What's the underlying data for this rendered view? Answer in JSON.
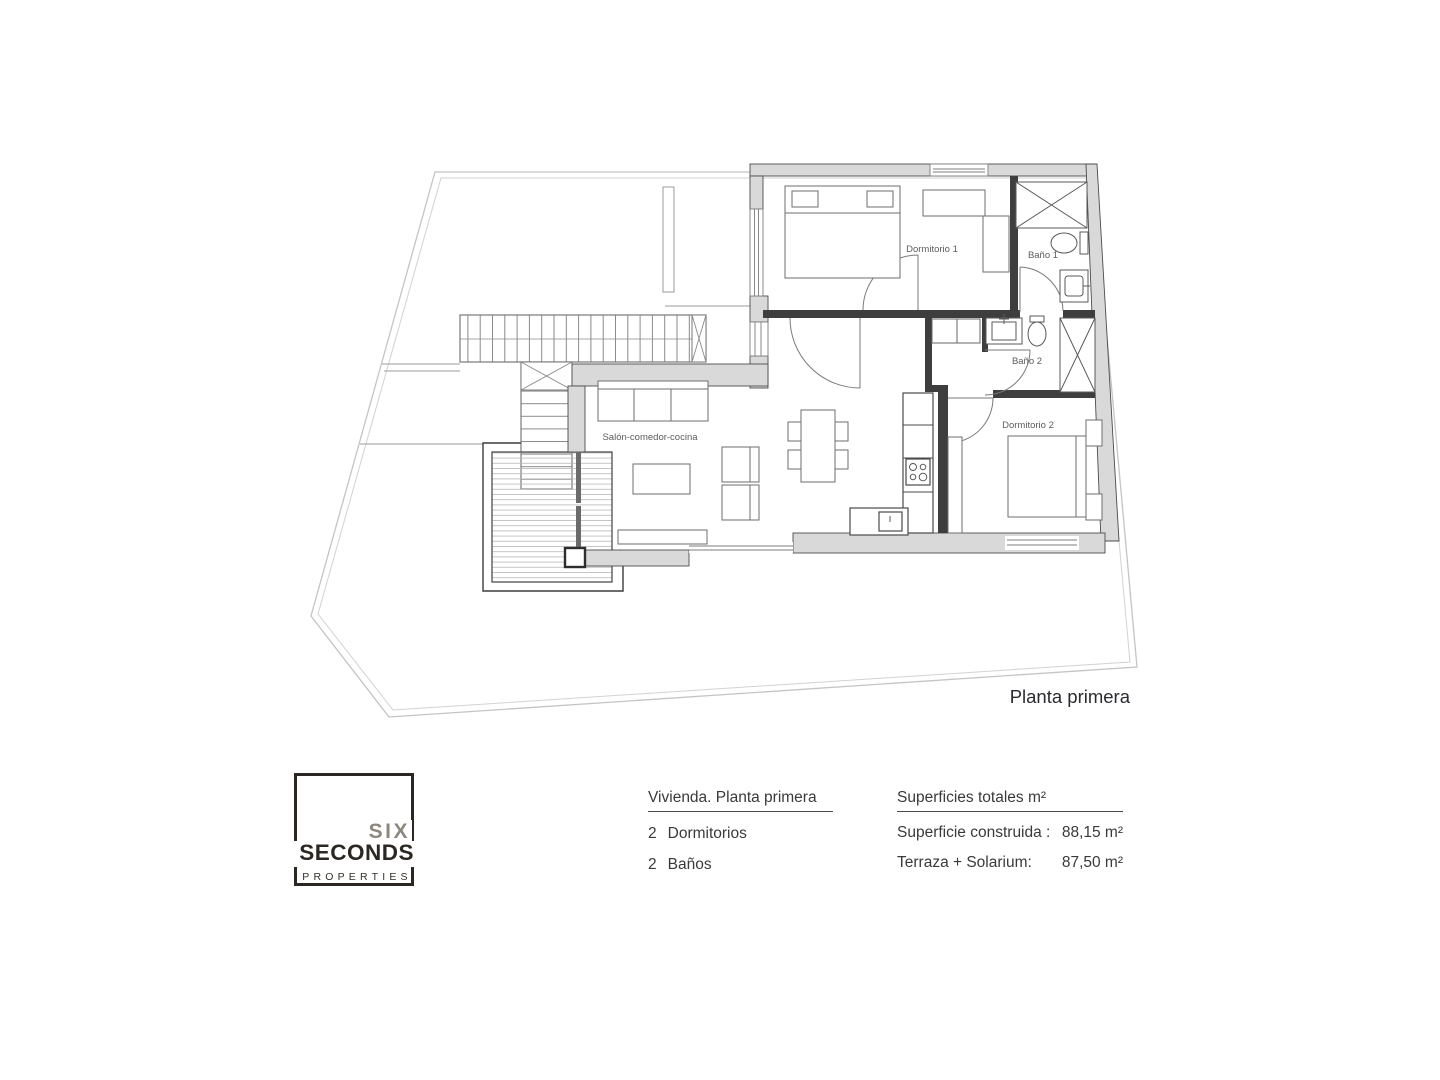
{
  "plan": {
    "title": "Planta primera",
    "labels": {
      "salon": "Salón-comedor-cocina",
      "dormitorio1": "Dormitorio 1",
      "bano1": "Baño 1",
      "bano2": "Baño 2",
      "dormitorio2": "Dormitorio 2"
    }
  },
  "logo": {
    "line1": "SIX",
    "line2": "SECONDS",
    "line3": "PROPERTIES"
  },
  "details": {
    "title": "Vivienda. Planta primera",
    "items": [
      {
        "count": "2",
        "label": "Dormitorios"
      },
      {
        "count": "2",
        "label": "Baños"
      }
    ]
  },
  "areas": {
    "title": "Superficies totales m²",
    "rows": [
      {
        "label": "Superficie construida :",
        "value": "88,15 m²"
      },
      {
        "label": "Terraza + Solarium:",
        "value": "87,50 m²"
      }
    ]
  },
  "colors": {
    "brand_gray": "#8d887f",
    "ink": "#2b2824",
    "wall_fill": "#d9d9d9",
    "wall_edge": "#4c4c4c",
    "boundary_gray": "#c4c4c4",
    "label_gray": "#5c5c5c"
  }
}
